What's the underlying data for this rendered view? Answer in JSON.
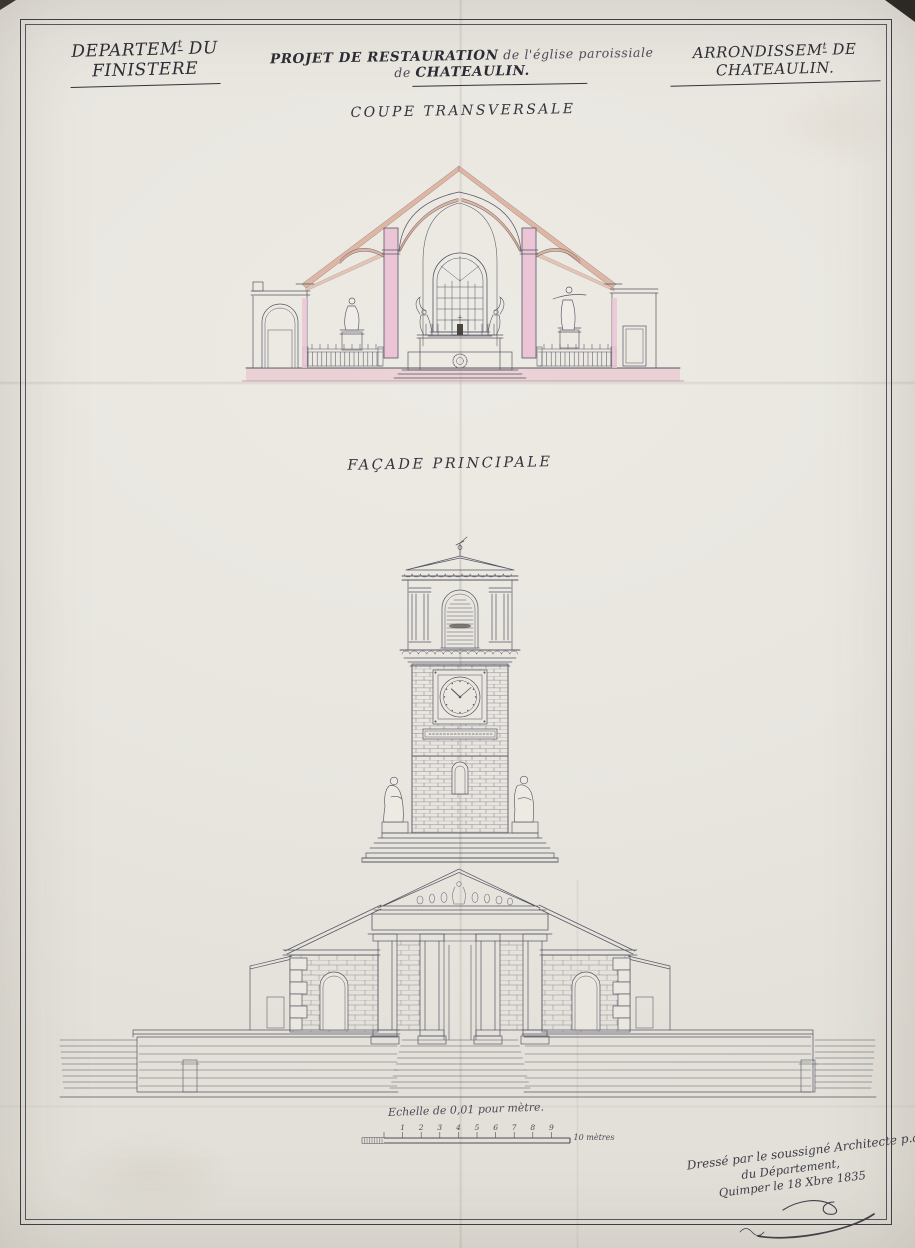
{
  "header": {
    "left": {
      "base": "DEPARTEM",
      "sup": "t",
      "rest": " DU FINISTERE"
    },
    "center": {
      "main": "PROJET DE RESTAURATION",
      "mid": " de l'église paroissiale de ",
      "place": "CHATEAULIN."
    },
    "right": {
      "base": "ARRONDISSEM",
      "sup": "t",
      "rest": " DE CHATEAULIN."
    }
  },
  "sections": {
    "coupe": "COUPE TRANSVERSALE",
    "facade": "FAÇADE PRINCIPALE"
  },
  "scale": {
    "caption": "Echelle de 0,01 pour mètre.",
    "numbers": [
      "1",
      "2",
      "3",
      "4",
      "5",
      "6",
      "7",
      "8",
      "9"
    ],
    "end": "10 mètres"
  },
  "signature": {
    "line1": "Dressé par le soussigné Architecte p.al",
    "line2": "du Département,",
    "line3": "Quimper le 18 Xbre 1835"
  },
  "colors": {
    "paper": "#e9e6e0",
    "ink": "#3c3c44",
    "pink_wash": "#ebc5d5",
    "salmon_wash": "#dcae9b",
    "ground_wash": "#e7bac9"
  }
}
